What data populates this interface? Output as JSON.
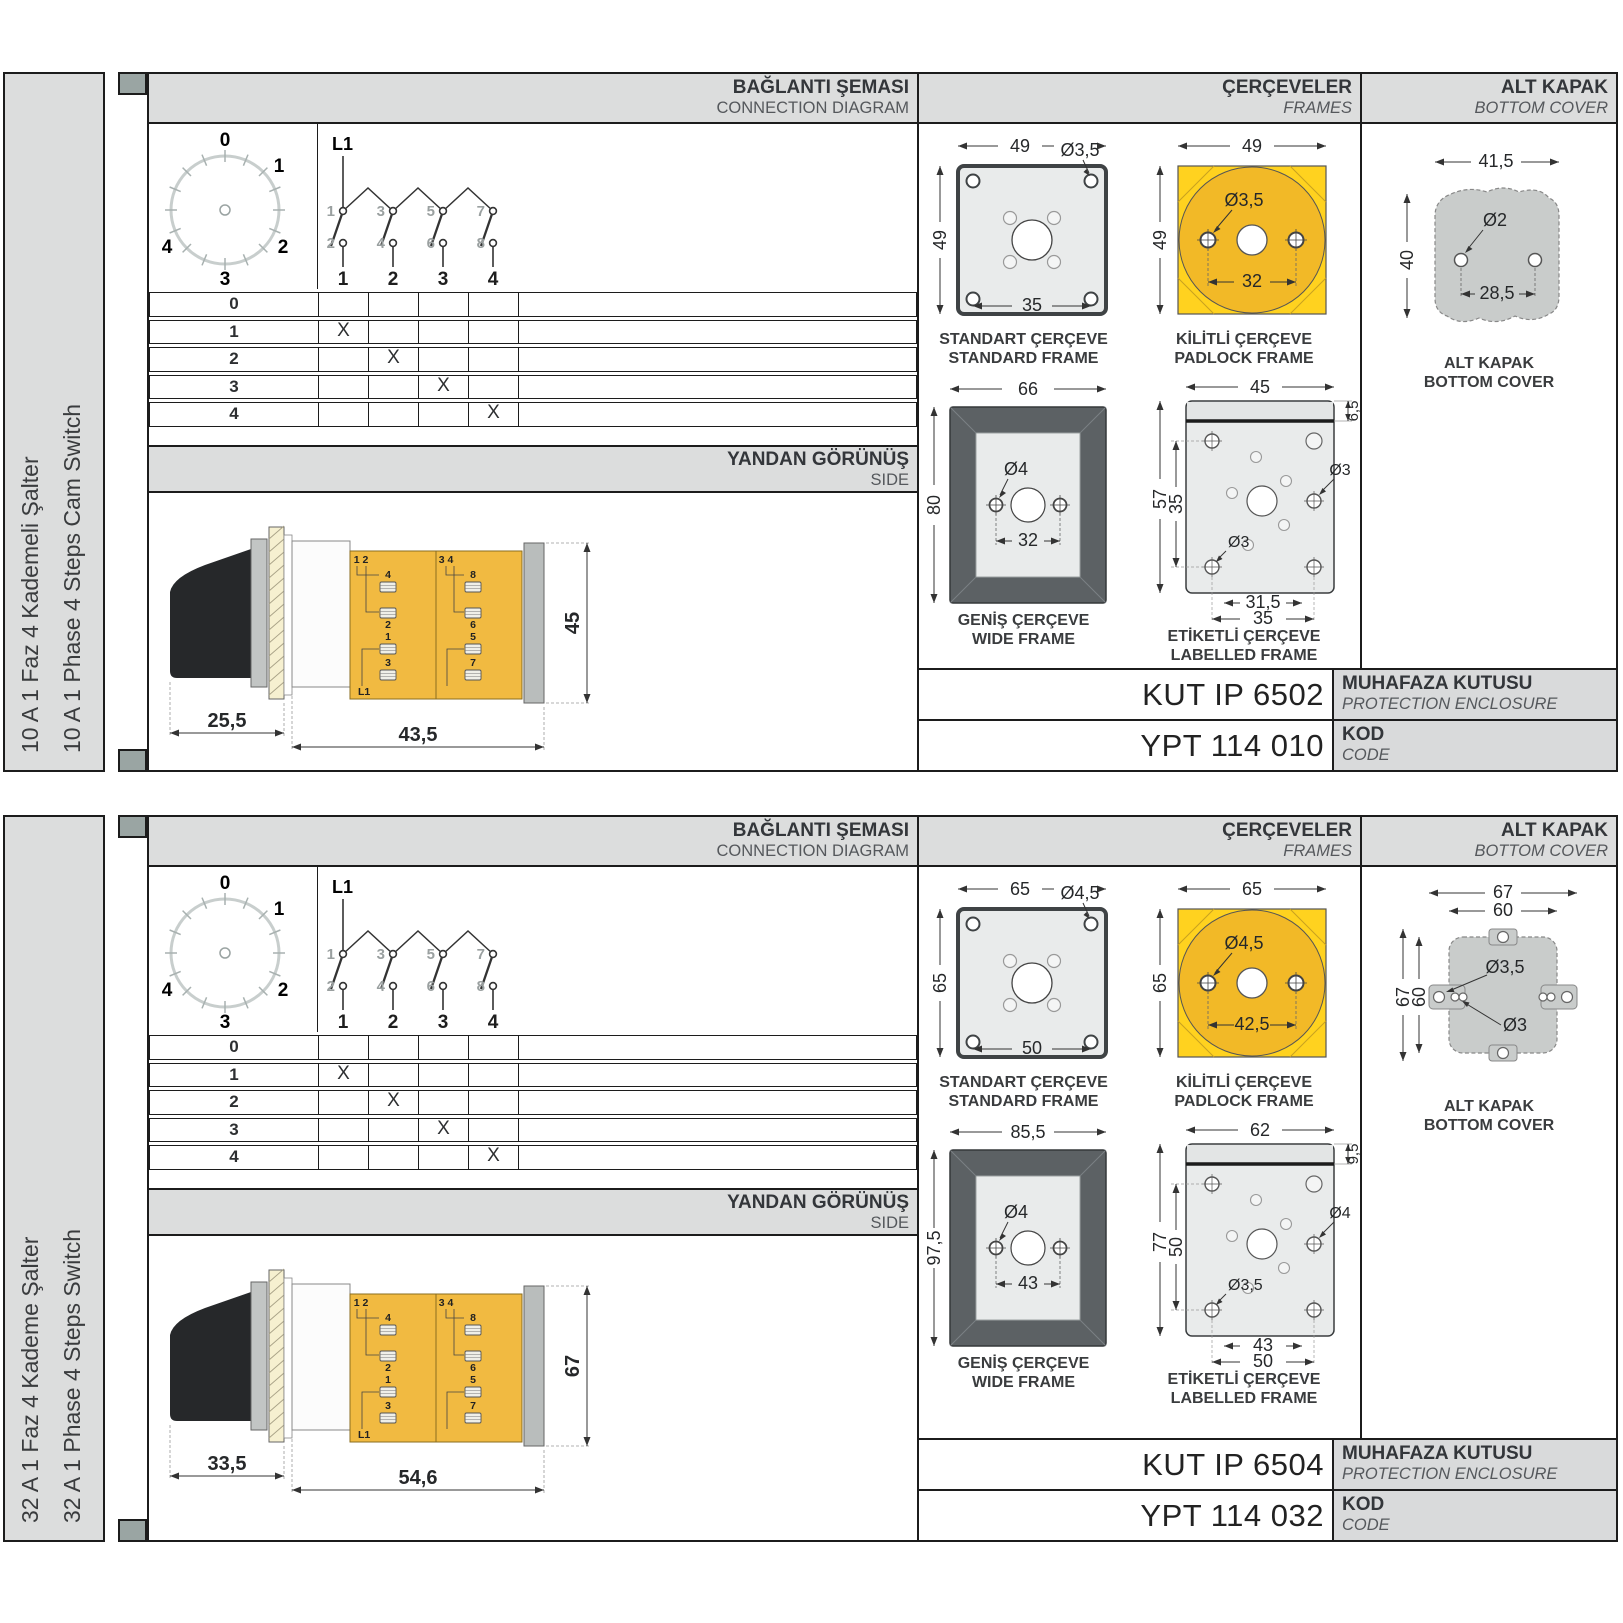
{
  "panels": [
    {
      "panel_class": "panel cover-blob",
      "sidebar": {
        "title_tr": "10 A 1 Faz 4 Kademeli Şalter",
        "title_en": "10 A 1 Phase 4 Steps Cam Switch"
      },
      "headers": {
        "connection_tr": "BAĞLANTI ŞEMASI",
        "connection_en": "CONNECTION DIAGRAM",
        "frames_tr": "ÇERÇEVELER",
        "frames_en": "FRAMES",
        "cover_tr": "ALT KAPAK",
        "cover_en": "BOTTOM COVER"
      },
      "diagram": {
        "feed": "L1",
        "dial_labels": [
          "0",
          "1",
          "2",
          "3",
          "4"
        ],
        "top_terms": [
          "1",
          "3",
          "5",
          "7"
        ],
        "bottom_terms": [
          "2",
          "4",
          "6",
          "8"
        ],
        "columns": [
          "1",
          "2",
          "3",
          "4"
        ]
      },
      "table": {
        "rows": [
          {
            "label": "0",
            "cells": [
              "",
              "",
              "",
              ""
            ]
          },
          {
            "label": "1",
            "cells": [
              "X",
              "",
              "",
              ""
            ]
          },
          {
            "label": "2",
            "cells": [
              "",
              "X",
              "",
              ""
            ]
          },
          {
            "label": "3",
            "cells": [
              "",
              "",
              "X",
              ""
            ]
          },
          {
            "label": "4",
            "cells": [
              "",
              "",
              "",
              "X"
            ]
          }
        ]
      },
      "side": {
        "header_tr": "YANDAN GÖRÜNÜŞ",
        "header_en": "SIDE",
        "dim_handle": "25,5",
        "dim_body": "43,5",
        "dim_height": "45",
        "terms": {
          "pair_left": "1 2",
          "pair_right": "3 4",
          "t4": "4",
          "t2": "2",
          "t1": "1",
          "t3": "3",
          "t8": "8",
          "t6": "6",
          "t5": "5",
          "t7": "7",
          "feed": "L1"
        }
      },
      "frames": {
        "standard": {
          "caption_tr": "STANDART ÇERÇEVE",
          "caption_en": "STANDARD FRAME",
          "dim_w": "49",
          "dim_h": "49",
          "dim_hole": "Ø3,5",
          "dim_inner": "35"
        },
        "padlock": {
          "caption_tr": "KİLİTLİ ÇERÇEVE",
          "caption_en": "PADLOCK FRAME",
          "dim_w": "49",
          "dim_h": "49",
          "dim_hole": "Ø3,5",
          "dim_inner": "32"
        },
        "wide": {
          "caption_tr": "GENİŞ ÇERÇEVE",
          "caption_en": "WIDE FRAME",
          "dim_w": "66",
          "dim_h": "80",
          "dim_hole": "Ø4",
          "dim_inner": "32"
        },
        "labelled": {
          "caption_tr": "ETİKETLİ ÇERÇEVE",
          "caption_en": "LABELLED FRAME",
          "dim_w": "45",
          "dim_h": "57",
          "dim_band": "6,5",
          "dim_inner_h": "35",
          "dim_hole_right": "Ø3",
          "dim_hole_bottom": "Ø3",
          "dim_bottom_inner": "31,5",
          "dim_bottom_outer": "35"
        }
      },
      "cover": {
        "caption_tr": "ALT KAPAK",
        "caption_en": "BOTTOM COVER",
        "dim_w": "41,5",
        "dim_h": "40",
        "dim_hole": "Ø2",
        "dim_inner": "28,5"
      },
      "codes": {
        "enclosure_value": "KUT IP 6502",
        "enclosure_label_tr": "MUHAFAZA KUTUSU",
        "enclosure_label_en": "PROTECTION ENCLOSURE",
        "code_value": "YPT 114 010",
        "code_label_tr": "KOD",
        "code_label_en": "CODE"
      }
    },
    {
      "panel_class": "panel cover-ears",
      "sidebar": {
        "title_tr": "32 A 1 Faz 4 Kademe Şalter",
        "title_en": "32 A 1 Phase 4 Steps Switch"
      },
      "headers": {
        "connection_tr": "BAĞLANTI ŞEMASI",
        "connection_en": "CONNECTION DIAGRAM",
        "frames_tr": "ÇERÇEVELER",
        "frames_en": "FRAMES",
        "cover_tr": "ALT KAPAK",
        "cover_en": "BOTTOM COVER"
      },
      "diagram": {
        "feed": "L1",
        "dial_labels": [
          "0",
          "1",
          "2",
          "3",
          "4"
        ],
        "top_terms": [
          "1",
          "3",
          "5",
          "7"
        ],
        "bottom_terms": [
          "2",
          "4",
          "6",
          "8"
        ],
        "columns": [
          "1",
          "2",
          "3",
          "4"
        ]
      },
      "table": {
        "rows": [
          {
            "label": "0",
            "cells": [
              "",
              "",
              "",
              ""
            ]
          },
          {
            "label": "1",
            "cells": [
              "X",
              "",
              "",
              ""
            ]
          },
          {
            "label": "2",
            "cells": [
              "",
              "X",
              "",
              ""
            ]
          },
          {
            "label": "3",
            "cells": [
              "",
              "",
              "X",
              ""
            ]
          },
          {
            "label": "4",
            "cells": [
              "",
              "",
              "",
              "X"
            ]
          }
        ]
      },
      "side": {
        "header_tr": "YANDAN GÖRÜNÜŞ",
        "header_en": "SIDE",
        "dim_handle": "33,5",
        "dim_body": "54,6",
        "dim_height": "67",
        "terms": {
          "pair_left": "1 2",
          "pair_right": "3 4",
          "t4": "4",
          "t2": "2",
          "t1": "1",
          "t3": "3",
          "t8": "8",
          "t6": "6",
          "t5": "5",
          "t7": "7",
          "feed": "L1"
        }
      },
      "frames": {
        "standard": {
          "caption_tr": "STANDART ÇERÇEVE",
          "caption_en": "STANDARD FRAME",
          "dim_w": "65",
          "dim_h": "65",
          "dim_hole": "Ø4,5",
          "dim_inner": "50"
        },
        "padlock": {
          "caption_tr": "KİLİTLİ ÇERÇEVE",
          "caption_en": "PADLOCK FRAME",
          "dim_w": "65",
          "dim_h": "65",
          "dim_hole": "Ø4,5",
          "dim_inner": "42,5"
        },
        "wide": {
          "caption_tr": "GENİŞ ÇERÇEVE",
          "caption_en": "WIDE FRAME",
          "dim_w": "85,5",
          "dim_h": "97,5",
          "dim_hole": "Ø4",
          "dim_inner": "43"
        },
        "labelled": {
          "caption_tr": "ETİKETLİ ÇERÇEVE",
          "caption_en": "LABELLED FRAME",
          "dim_w": "62",
          "dim_h": "77",
          "dim_band": "9,5",
          "dim_inner_h": "50",
          "dim_hole_right": "Ø4",
          "dim_hole_bottom": "Ø3,5",
          "dim_bottom_inner": "43",
          "dim_bottom_outer": "50"
        }
      },
      "cover": {
        "caption_tr": "ALT KAPAK",
        "caption_en": "BOTTOM COVER",
        "dim_w_outer": "67",
        "dim_w_inner": "60",
        "dim_h_outer": "67",
        "dim_h_inner": "60",
        "dim_hole_outer": "Ø3,5",
        "dim_hole_inner": "Ø3"
      },
      "codes": {
        "enclosure_value": "KUT IP 6504",
        "enclosure_label_tr": "MUHAFAZA KUTUSU",
        "enclosure_label_en": "PROTECTION ENCLOSURE",
        "code_value": "YPT 114 032",
        "code_label_tr": "KOD",
        "code_label_en": "CODE"
      }
    }
  ],
  "colors": {
    "band_gray": "#dcdddd",
    "spine_square": "#9aa5a3",
    "padlock_yellow": "#ffd21f",
    "padlock_circle": "#f2b927",
    "body_yellow": "#f1ba41",
    "wide_frame_dark": "#5c6164",
    "cover_gray": "#c9cccb"
  }
}
